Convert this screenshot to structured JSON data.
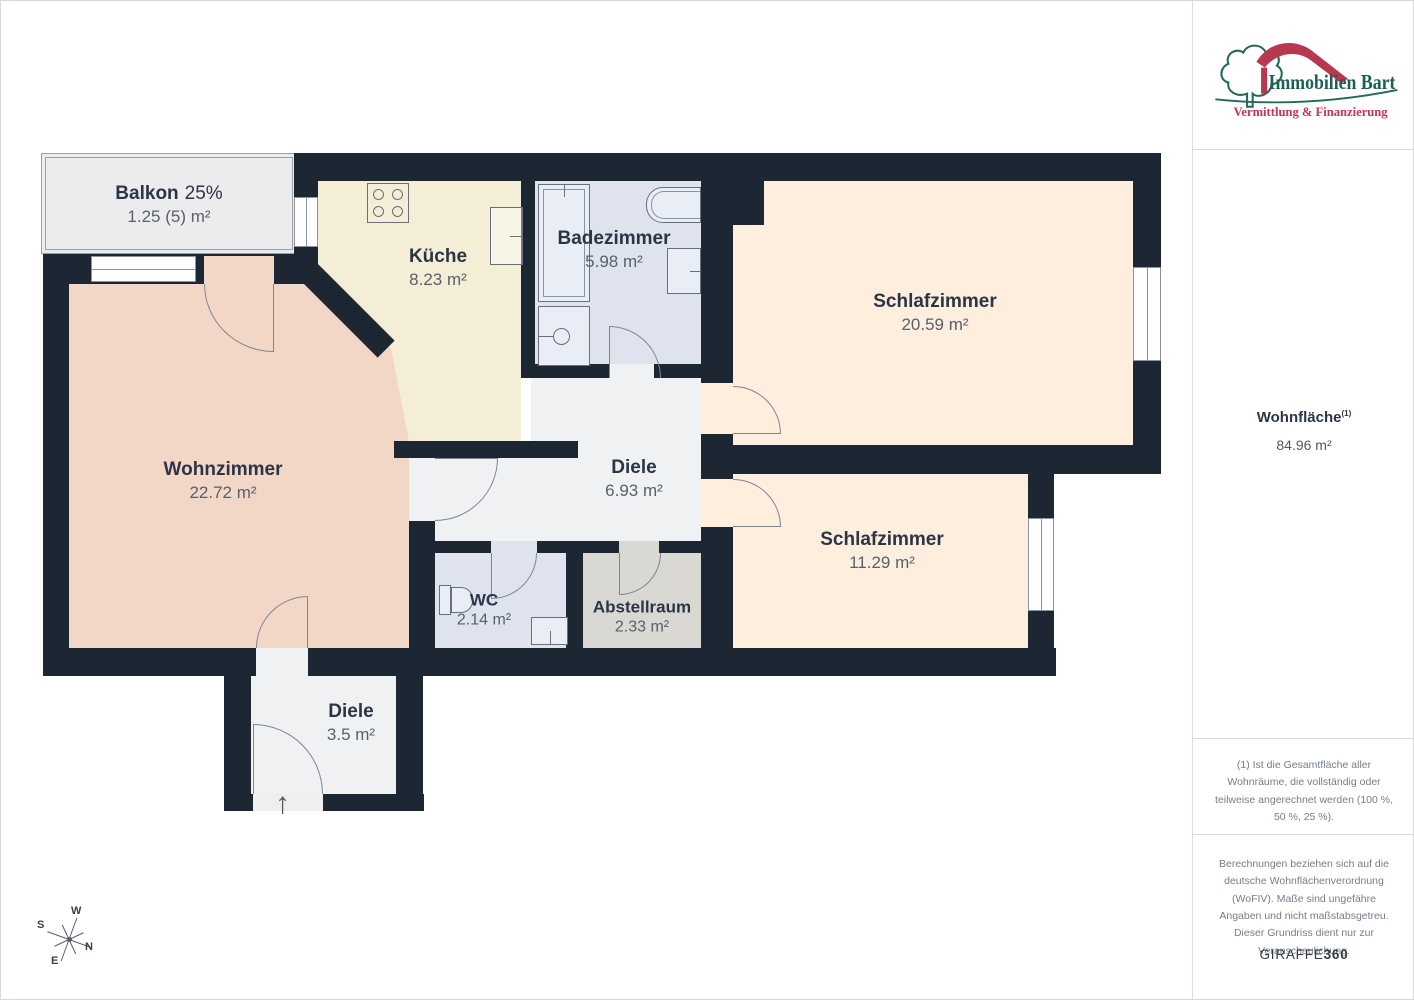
{
  "floorplan": {
    "rooms": {
      "balkon": {
        "name": "Balkon",
        "suffix": "25%",
        "area": "1.25 (5) m²"
      },
      "kueche": {
        "name": "Küche",
        "area": "8.23 m²"
      },
      "badezimmer": {
        "name": "Badezimmer",
        "area": "5.98 m²"
      },
      "schlafzimmer1": {
        "name": "Schlafzimmer",
        "area": "20.59 m²"
      },
      "wohnzimmer": {
        "name": "Wohnzimmer",
        "area": "22.72 m²"
      },
      "diele1": {
        "name": "Diele",
        "area": "6.93 m²"
      },
      "schlafzimmer2": {
        "name": "Schlafzimmer",
        "area": "11.29 m²"
      },
      "wc": {
        "name": "WC",
        "area": "2.14 m²"
      },
      "abstellraum": {
        "name": "Abstellraum",
        "area": "2.33 m²"
      },
      "diele2": {
        "name": "Diele",
        "area": "3.5 m²"
      }
    },
    "compass": {
      "n": "N",
      "s": "S",
      "e": "E",
      "w": "W"
    },
    "entrance_arrow": "↑"
  },
  "sidebar": {
    "logo": {
      "brand": "Immobilien Bart",
      "tagline": "Vermittlung & Finanzierung"
    },
    "total": {
      "label": "Wohnfläche",
      "footnote_ref": "(1)",
      "value": "84.96 m²"
    },
    "footnote1": "(1) Ist die Gesamtfläche aller Wohnräume, die vollständig oder teilweise angerechnet werden (100 %, 50 %, 25 %).",
    "footnote2": "Berechnungen beziehen sich auf die deutsche Wohnflächenverordnung (WoFIV). Maße sind ungefähre Angaben und nicht maßstabsgetreu. Dieser Grundriss dient nur zur Veranschaulichung.",
    "brand360": {
      "giraffe": "GIRAFFE",
      "num": "360"
    }
  },
  "colors": {
    "wall": "#1c2733",
    "bedroom_fill": "#fdeedd",
    "livingroom_fill": "#f3d7c6",
    "kitchen_fill": "#f5eed6",
    "bath_fill": "#dfe3ee",
    "hall_fill": "#f0f1f3",
    "storage_fill": "#d9d8d3",
    "balcony_fill": "#ececee",
    "logo_green": "#23685c",
    "logo_red": "#b7394f"
  }
}
